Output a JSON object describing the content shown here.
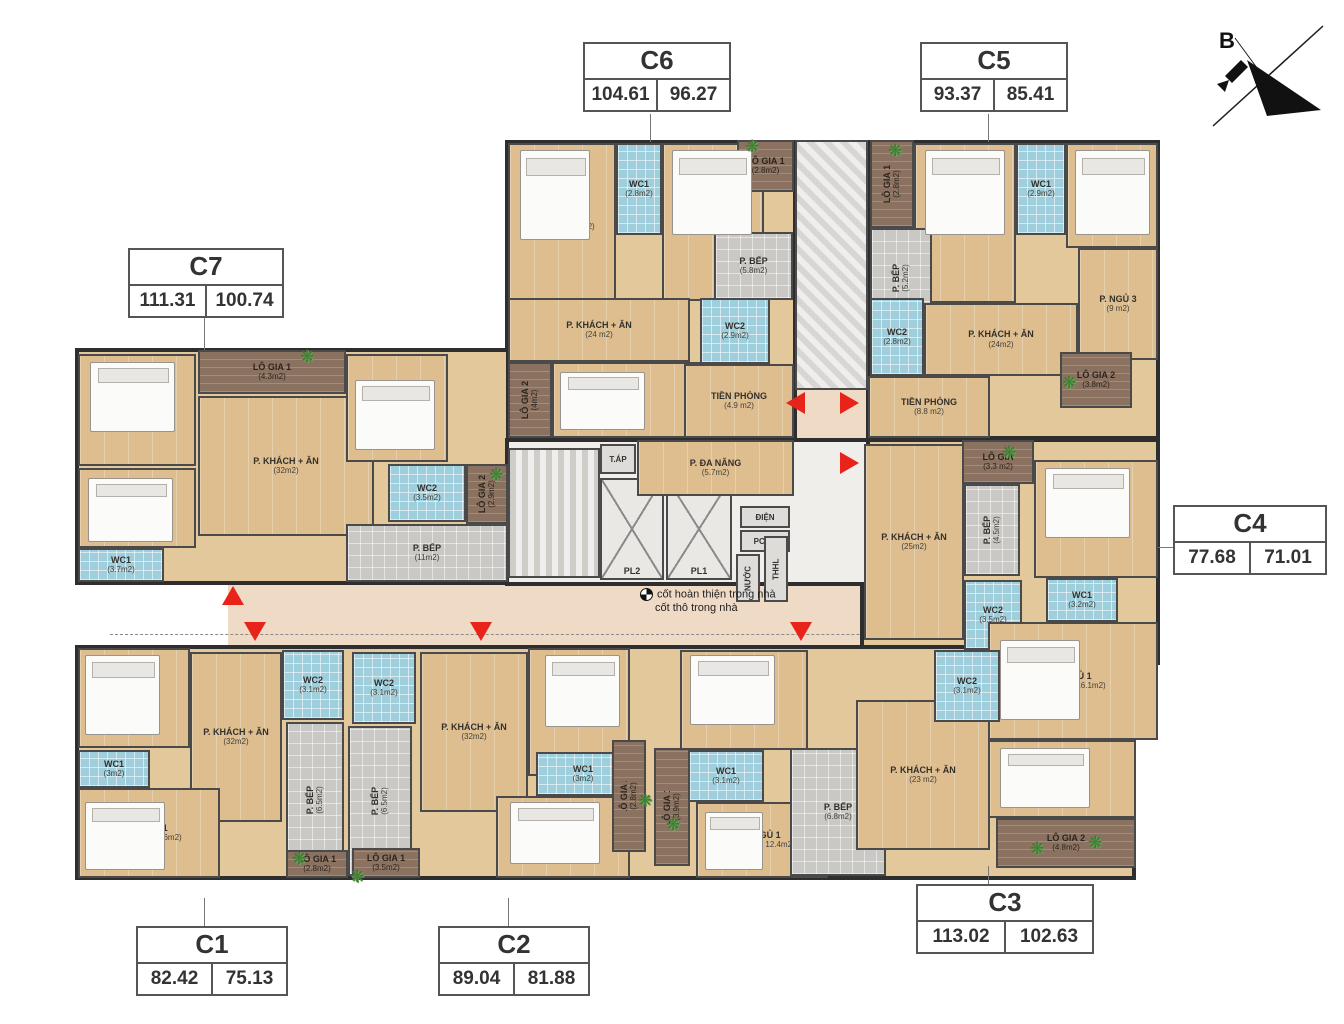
{
  "compass": {
    "label": "B"
  },
  "note": {
    "line1": "cốt hoàn thiện trong nhà",
    "line2": "cốt thô trong nhà"
  },
  "core": {
    "pl1": "PL1",
    "pl2": "PL2",
    "tap": "T.ÁP",
    "dien": "ĐIỆN",
    "pccc": "PCCC",
    "nuoc": "NƯỚC",
    "shaft": "THHL"
  },
  "units": {
    "C1": {
      "id": "C1",
      "gross": "82.42",
      "net": "75.13",
      "rooms": {
        "ngu2": {
          "name": "P. NGỦ 2",
          "area": "(10m2)"
        },
        "wc2": {
          "name": "WC2",
          "area": "(3.1m2)"
        },
        "khach": {
          "name": "P. KHÁCH + ĂN",
          "area": "(32m2)"
        },
        "wc1": {
          "name": "WC1",
          "area": "(3m2)"
        },
        "ngu1": {
          "name": "P. NGỦ 1",
          "area": "(18.1m2 / 14.6m2)"
        },
        "bep": {
          "name": "P. BẾP",
          "area": "(6.5m2)"
        },
        "logia1": {
          "name": "LÔ GIA 1",
          "area": "(2.8m2)"
        }
      }
    },
    "C2": {
      "id": "C2",
      "gross": "89.04",
      "net": "81.88",
      "rooms": {
        "wc2": {
          "name": "WC2",
          "area": "(3.1m2)"
        },
        "khach": {
          "name": "P. KHÁCH + ĂN",
          "area": "(32m2)"
        },
        "bep": {
          "name": "P. BẾP",
          "area": "(6.5m2)"
        },
        "ngu2": {
          "name": "P. NGỦ 2",
          "area": "(13.5m2)"
        },
        "wc1": {
          "name": "WC1",
          "area": "(3m2)"
        },
        "ngu1": {
          "name": "P. NGỦ 1",
          "area": "(17.2m2 / 14.2 m2)"
        },
        "logia1": {
          "name": "LÔ GIA 1",
          "area": "(3.5m2)"
        },
        "logia2": {
          "name": "LÔ GIA 2",
          "area": "(2.8m2)"
        }
      }
    },
    "C3": {
      "id": "C3",
      "gross": "113.02",
      "net": "102.63",
      "rooms": {
        "ngu2": {
          "name": "P. NGỦ 2",
          "area": "(11.4m2)"
        },
        "wc1": {
          "name": "WC1",
          "area": "(3.1m2)"
        },
        "ngu1": {
          "name": "P. NGỦ 1",
          "area": "(15.5m2 / 12.4m2)"
        },
        "logia1": {
          "name": "LÔ GIA 1",
          "area": "(3.9m2)"
        },
        "bep": {
          "name": "P. BẾP",
          "area": "(6.8m2)"
        },
        "khach": {
          "name": "P. KHÁCH + ĂN",
          "area": "(23 m2)"
        },
        "wc2": {
          "name": "WC2",
          "area": "(3.1m2)"
        },
        "ngu3": {
          "name": "P. NGỦ 3",
          "area": "(13.8m2)"
        },
        "logia2": {
          "name": "LÔ GIA 2",
          "area": "(4.8m2)"
        }
      }
    },
    "C4": {
      "id": "C4",
      "gross": "77.68",
      "net": "71.01",
      "rooms": {
        "logia": {
          "name": "LÔ GIA",
          "area": "(3.3 m2)"
        },
        "bep": {
          "name": "P. BẾP",
          "area": "(4.5m2)"
        },
        "khach": {
          "name": "P. KHÁCH + ĂN",
          "area": "(25m2)"
        },
        "ngu2": {
          "name": "P. NGỦ 2",
          "area": "(10.7m2)"
        },
        "wc2": {
          "name": "WC2",
          "area": "(3.5m2)"
        },
        "wc1": {
          "name": "WC1",
          "area": "(3.2m2)"
        },
        "ngu1": {
          "name": "P. NGỦ 1",
          "area": "(19.3m2 / 16.1m2)"
        }
      }
    },
    "C5": {
      "id": "C5",
      "gross": "93.37",
      "net": "85.41",
      "rooms": {
        "logia1": {
          "name": "LÔ GIA 1",
          "area": "(2.8m2)"
        },
        "ngu2": {
          "name": "P. NGỦ 2",
          "area": "(10.2m2)"
        },
        "wc1": {
          "name": "WC1",
          "area": "(2.9m2)"
        },
        "ngu1": {
          "name": "P. NGỦ 1",
          "area": "(15.7m2 / 12.9m2)"
        },
        "bep": {
          "name": "P. BẾP",
          "area": "(5.2m2)"
        },
        "khach": {
          "name": "P. KHÁCH + ĂN",
          "area": "(24m2)"
        },
        "ngu3": {
          "name": "P. NGỦ 3",
          "area": "(9 m2)"
        },
        "wc2": {
          "name": "WC2",
          "area": "(2.8m2)"
        },
        "tienphong": {
          "name": "TIỀN PHÒNG",
          "area": "(8.8 m2)"
        },
        "logia2": {
          "name": "LÔ GIA 2",
          "area": "(3.8m2)"
        }
      }
    },
    "C6": {
      "id": "C6",
      "gross": "104.61",
      "net": "96.27",
      "rooms": {
        "ngu1": {
          "name": "P. NGỦ 1",
          "area": "(15.7m2 / 12.9m2)"
        },
        "wc1": {
          "name": "WC1",
          "area": "(2.8m2)"
        },
        "ngu2": {
          "name": "P. NGỦ 2",
          "area": "(10.2m2)"
        },
        "logia1": {
          "name": "LÔ GIA 1",
          "area": "(2.8m2)"
        },
        "bep": {
          "name": "P. BẾP",
          "area": "(5.8m2)"
        },
        "khach": {
          "name": "P. KHÁCH + ĂN",
          "area": "(24 m2)"
        },
        "logia2": {
          "name": "LÔ GIA 2",
          "area": "(4m2)"
        },
        "ngu3": {
          "name": "P. NGỦ 3",
          "area": "(12.5m2)"
        },
        "wc2": {
          "name": "WC2",
          "area": "(2.9m2)"
        },
        "tienphong": {
          "name": "TIỀN PHÒNG",
          "area": "(4.9 m2)"
        },
        "danang": {
          "name": "P. ĐA NĂNG",
          "area": "(5.7m2)"
        }
      }
    },
    "C7": {
      "id": "C7",
      "gross": "111.31",
      "net": "100.74",
      "rooms": {
        "logia1": {
          "name": "LÔ GIA 1",
          "area": "(4.3m2)"
        },
        "ngu2": {
          "name": "P. NGỦ 2",
          "area": "(12.2m2)"
        },
        "ngu1": {
          "name": "P. NGỦ 1",
          "area": "(19.2m2 / 15.5m2)"
        },
        "wc1": {
          "name": "WC1",
          "area": "(3.7m2)"
        },
        "khach": {
          "name": "P. KHÁCH + ĂN",
          "area": "(32m2)"
        },
        "ngu3": {
          "name": "P. NGỦ 3",
          "area": "(11.2m2)"
        },
        "wc2": {
          "name": "WC2",
          "area": "(3.5m2)"
        },
        "logia2": {
          "name": "LÔ GIA 2",
          "area": "(2.9m2)"
        },
        "bep": {
          "name": "P. BẾP",
          "area": "(11m2)"
        }
      }
    }
  }
}
